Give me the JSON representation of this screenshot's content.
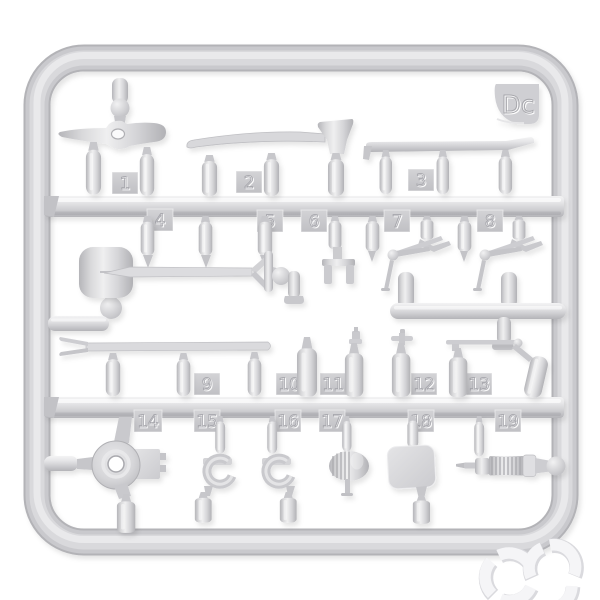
{
  "photo": {
    "subject": "injection-molded plastic model kit sprue with pioneer tools",
    "background_color": "#ffffff",
    "plastic_color": "#d4d4d7",
    "tag_color": "#c7c7cb"
  },
  "sprue": {
    "gate_label": "Dc",
    "part_tags": [
      "1",
      "2",
      "3",
      "4",
      "5",
      "6",
      "7",
      "8",
      "9",
      "10",
      "11",
      "12",
      "13",
      "14",
      "15",
      "16",
      "17",
      "18",
      "19"
    ],
    "parts": [
      {
        "number": "1",
        "tool": "mattock head"
      },
      {
        "number": "2",
        "tool": "axe"
      },
      {
        "number": "3",
        "tool": "crowbar"
      },
      {
        "number": "4",
        "tool": "tool handle grips"
      },
      {
        "number": "5",
        "tool": "tool handle grip"
      },
      {
        "number": "6",
        "tool": "fork bracket"
      },
      {
        "number": "7",
        "tool": "lever latch"
      },
      {
        "number": "8",
        "tool": "lever latch"
      },
      {
        "number": "9",
        "tool": "pry bar"
      },
      {
        "number": "10",
        "tool": "canister"
      },
      {
        "number": "11",
        "tool": "capped canister"
      },
      {
        "number": "12",
        "tool": "valve canister"
      },
      {
        "number": "13",
        "tool": "canister with pump rod"
      },
      {
        "number": "14",
        "tool": "cable drum hub"
      },
      {
        "number": "15",
        "tool": "clamp bracket"
      },
      {
        "number": "16",
        "tool": "clamp bracket"
      },
      {
        "number": "17",
        "tool": "ribbed horn"
      },
      {
        "number": "18",
        "tool": "stowage plate"
      },
      {
        "number": "19",
        "tool": "grease gun"
      }
    ],
    "unlabeled_parts": [
      "shovel with D-handle"
    ]
  },
  "watermark": {
    "icon": "segmented-arc-rings-logo",
    "color": "#f5f5f7"
  }
}
